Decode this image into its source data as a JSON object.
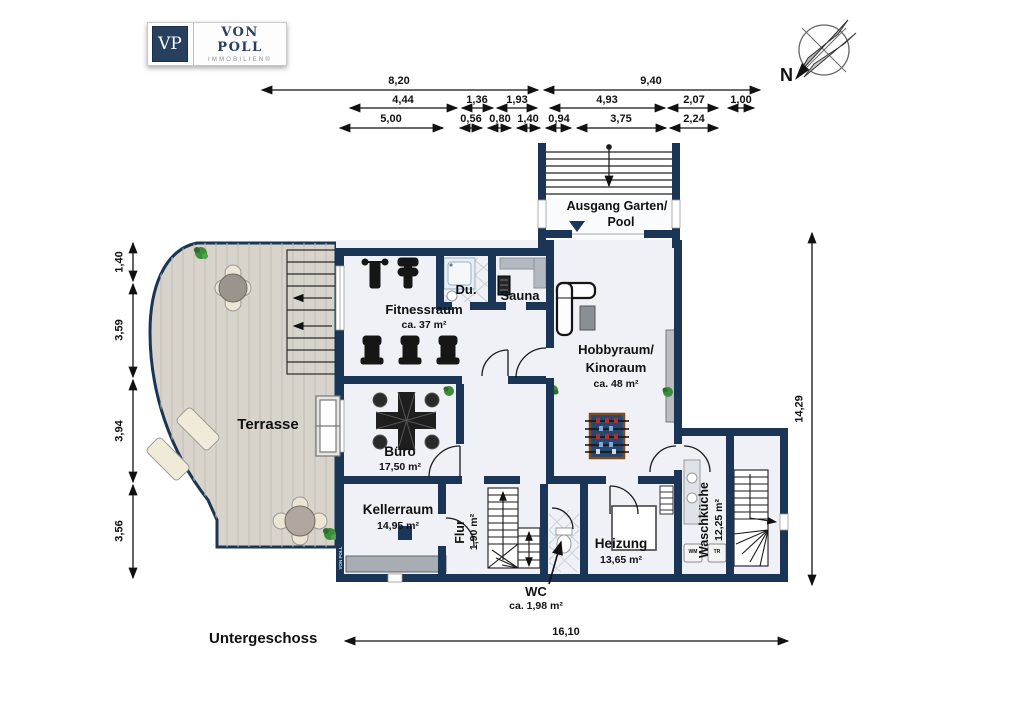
{
  "branding": {
    "logo_monogram": "VP",
    "logo_name": "VON POLL",
    "logo_subtitle": "IMMOBILIEN®",
    "watermark": "VON POLL"
  },
  "compass": {
    "north_label": "N"
  },
  "plan": {
    "floor_label": "Untergeschoss"
  },
  "rooms": {
    "ausgang": {
      "line1": "Ausgang Garten/",
      "line2": "Pool"
    },
    "fitnessraum": {
      "name": "Fitnessraum",
      "area": "ca. 37 m²"
    },
    "dusche": {
      "name": "Du."
    },
    "sauna": {
      "name": "Sauna"
    },
    "hobbyraum": {
      "name_line1": "Hobbyraum/",
      "name_line2": "Kinoraum",
      "area": "ca. 48 m²"
    },
    "terrasse": {
      "name": "Terrasse"
    },
    "buero": {
      "name": "Büro",
      "area": "17,50 m²"
    },
    "kellerraum": {
      "name": "Kellerraum",
      "area": "14,95 m²"
    },
    "flur": {
      "name": "Flur",
      "area": "1,90 m²"
    },
    "wc": {
      "name": "WC",
      "area": "ca. 1,98 m²"
    },
    "heizung": {
      "name": "Heizung",
      "area": "13,65 m²"
    },
    "waschkueche": {
      "name": "Waschküche",
      "area": "12,25 m²",
      "washer": "WM",
      "dryer": "TR"
    }
  },
  "dimensions": {
    "top_row1": [
      "8,20",
      "9,40"
    ],
    "top_row2": [
      "4,44",
      "1,36",
      "1,93",
      "4,93",
      "2,07",
      "1,00"
    ],
    "top_row3": [
      "5,00",
      "0,56",
      "0,80",
      "1,40",
      "0,94",
      "3,75",
      "2,24"
    ],
    "left": [
      "1,40",
      "3,59",
      "3,94",
      "3,56"
    ],
    "right": "14,29",
    "bottom": "16,10"
  },
  "colors": {
    "wall": "#1a3556",
    "room_fill": "#eff1f6",
    "terrace_fill": "#d8d4cc",
    "accent_green": "#3d8b3d"
  }
}
